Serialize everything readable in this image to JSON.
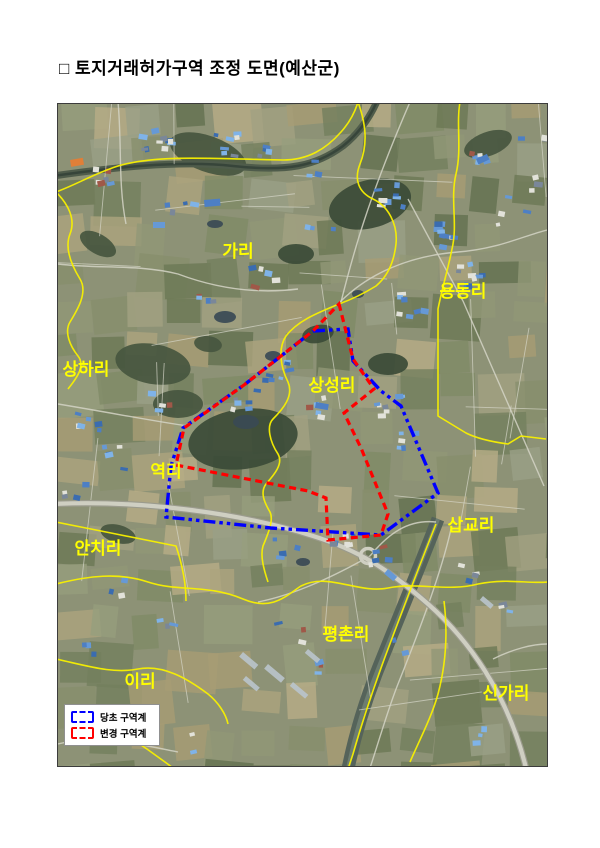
{
  "page": {
    "title": "□ 토지거래허가구역 조정 도면(예산군)"
  },
  "map": {
    "label_color": "#ffff00",
    "admin_boundary_color": "#f8f000",
    "original_zone_color": "#0000ff",
    "changed_zone_color": "#ff0000",
    "labels": [
      {
        "id": "gari",
        "text": "가리",
        "x": 180,
        "y": 153
      },
      {
        "id": "yongdongri",
        "text": "용동리",
        "x": 405,
        "y": 193
      },
      {
        "id": "sanghari",
        "text": "상하리",
        "x": 28,
        "y": 271
      },
      {
        "id": "sangseongri",
        "text": "상성리",
        "x": 274,
        "y": 287
      },
      {
        "id": "yeokri",
        "text": "역리",
        "x": 108,
        "y": 373
      },
      {
        "id": "sapgyori",
        "text": "삽교리",
        "x": 413,
        "y": 427
      },
      {
        "id": "anchiri",
        "text": "안치리",
        "x": 40,
        "y": 450
      },
      {
        "id": "pyeongchonri",
        "text": "평촌리",
        "x": 288,
        "y": 536
      },
      {
        "id": "iri",
        "text": "이리",
        "x": 82,
        "y": 583
      },
      {
        "id": "singari",
        "text": "신가리",
        "x": 448,
        "y": 595
      }
    ],
    "zones": {
      "original_points": "255,227 290,225 295,257 323,287 343,302 380,389 323,431 213,424 108,413 113,362 125,324 186,281",
      "changed_points": "281,200 295,255 316,285 286,309 303,344 330,410 323,431 270,436 268,394 250,387 118,361 126,324 186,281 255,227"
    },
    "legend": {
      "items": [
        {
          "label": "당초 구역계",
          "color": "#0000ff"
        },
        {
          "label": "변경 구역계",
          "color": "#ff0000"
        }
      ]
    }
  }
}
